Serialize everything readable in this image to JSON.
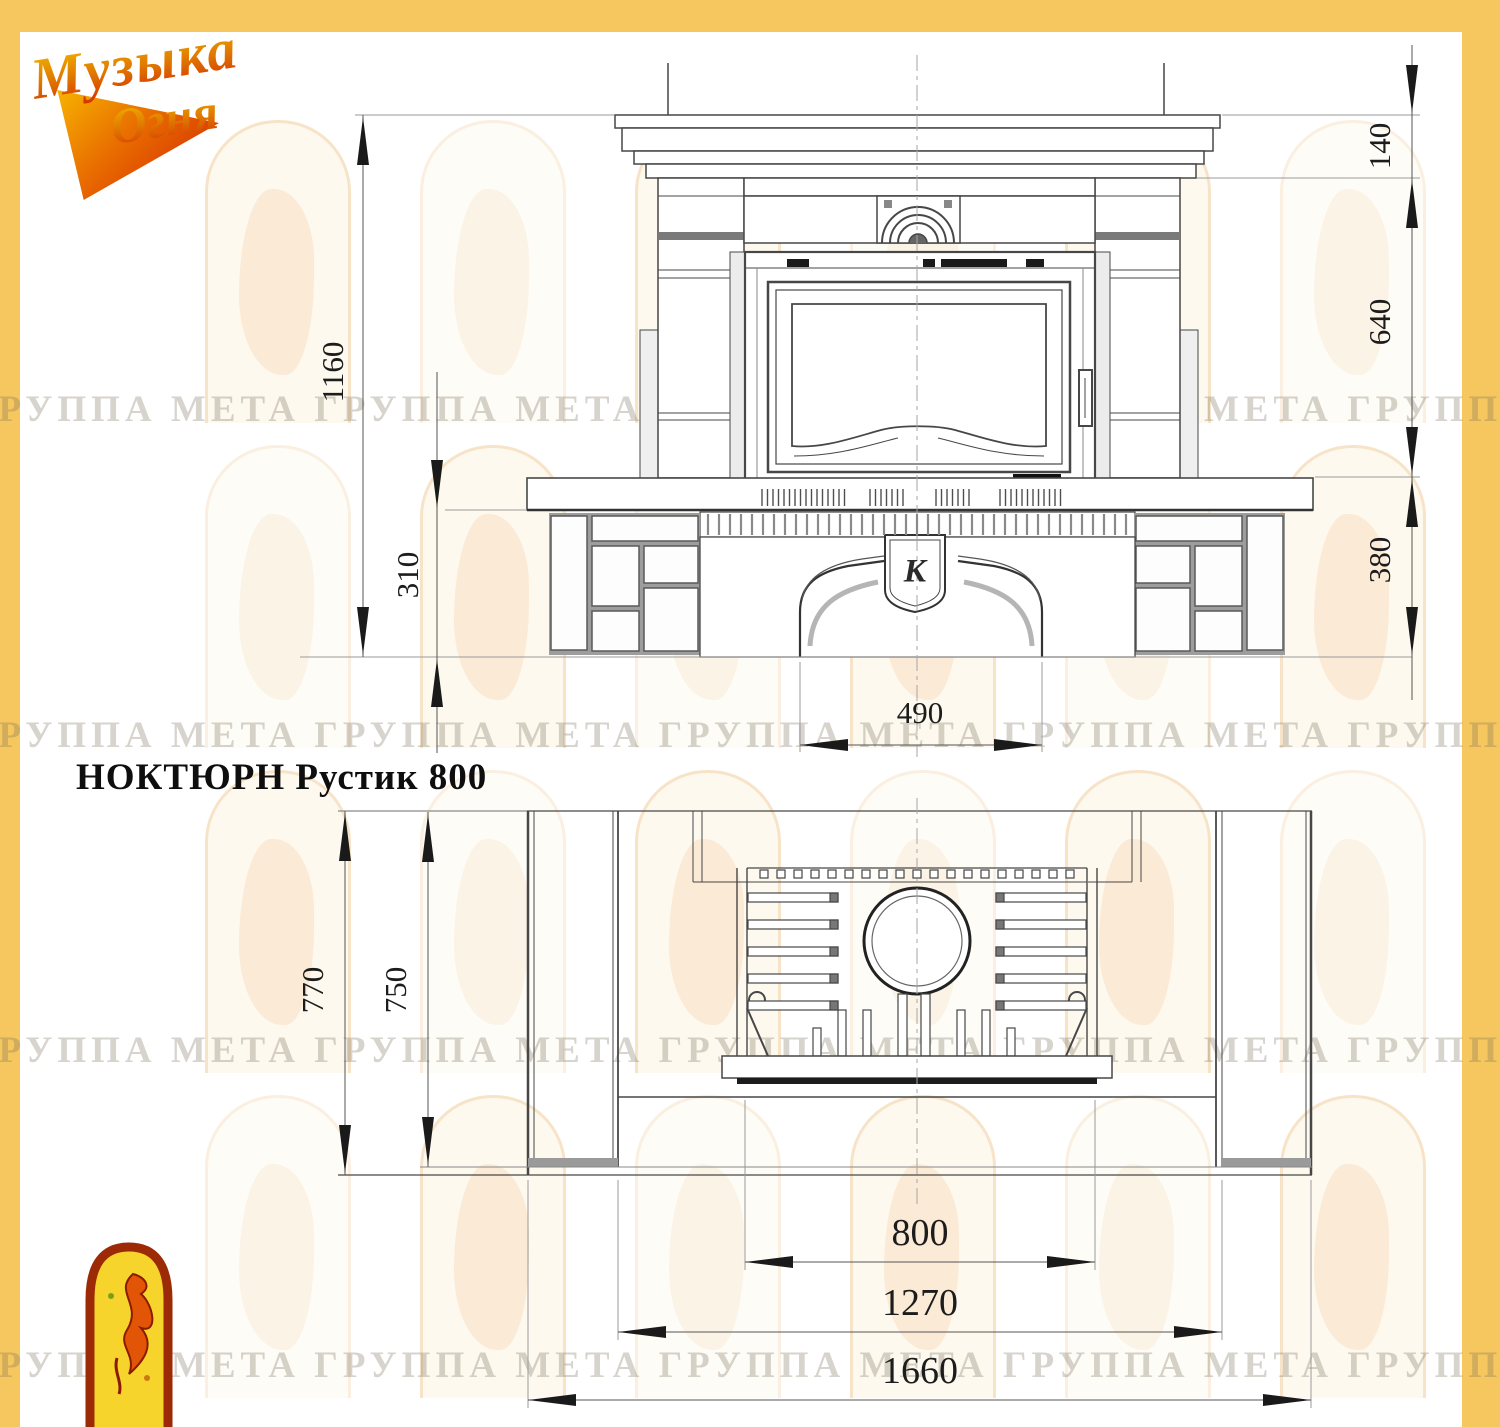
{
  "brand": {
    "logo_line1": "Музыка",
    "logo_line2": "Огня"
  },
  "title": "НОКТЮРН Рустик 800",
  "emblem_letter": "К",
  "watermark": {
    "phrase": "ГРУППА МЕТА",
    "rows": 4,
    "repeats_per_row": 6
  },
  "front_view": {
    "dims": {
      "total_height": "1160",
      "hearth_clearance": "310",
      "base_opening_width": "490",
      "mantel_height": "140",
      "body_height": "640",
      "base_height": "380"
    }
  },
  "plan_view": {
    "dims": {
      "total_depth": "770",
      "inner_depth": "750",
      "firebox_width": "800",
      "body_width": "1270",
      "total_width": "1660"
    }
  },
  "colors": {
    "frame_yellow": "#f5c75e",
    "line_dark": "#474747",
    "watermark_text": "#7a6e58"
  }
}
